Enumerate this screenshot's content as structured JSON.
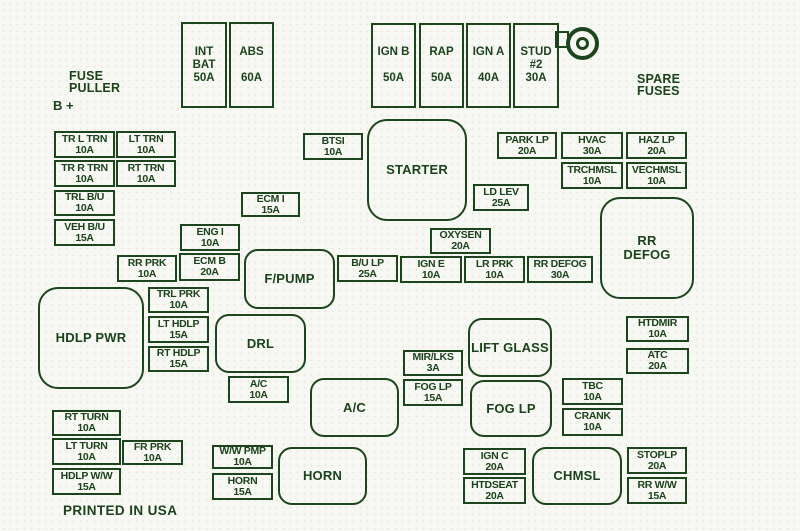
{
  "colors": {
    "line": "#1d451d",
    "background": "#f7f8f3"
  },
  "texts": {
    "fuse_puller": [
      "FUSE",
      "PULLER"
    ],
    "b_plus": "B +",
    "spare_fuses": [
      "SPARE",
      "FUSES"
    ],
    "printed_in_usa": "PRINTED IN USA"
  },
  "icons": {
    "stud_ring": "ring-terminal-icon"
  },
  "maxi_fuses": {
    "int_bat": {
      "name": "INT BAT",
      "amp": "50A"
    },
    "abs": {
      "name": "ABS",
      "amp": "60A"
    },
    "ign_b": {
      "name": "IGN B",
      "amp": "50A"
    },
    "rap": {
      "name": "RAP",
      "amp": "50A"
    },
    "ign_a": {
      "name": "IGN A",
      "amp": "40A"
    },
    "stud_2": {
      "name": "STUD #2",
      "amp": "30A"
    }
  },
  "fuses": {
    "tr_l_trn": {
      "name": "TR L TRN",
      "amp": "10A"
    },
    "lt_trn": {
      "name": "LT TRN",
      "amp": "10A"
    },
    "tr_r_trn": {
      "name": "TR R TRN",
      "amp": "10A"
    },
    "rt_trn": {
      "name": "RT TRN",
      "amp": "10A"
    },
    "trl_bu": {
      "name": "TRL B/U",
      "amp": "10A"
    },
    "veh_bu": {
      "name": "VEH B/U",
      "amp": "15A"
    },
    "btsi": {
      "name": "BTSI",
      "amp": "10A"
    },
    "park_lp": {
      "name": "PARK LP",
      "amp": "20A"
    },
    "hvac": {
      "name": "HVAC",
      "amp": "30A"
    },
    "haz_lp": {
      "name": "HAZ LP",
      "amp": "20A"
    },
    "trchmsl": {
      "name": "TRCHMSL",
      "amp": "10A"
    },
    "vechmsl": {
      "name": "VECHMSL",
      "amp": "10A"
    },
    "ecm_i": {
      "name": "ECM I",
      "amp": "15A"
    },
    "ld_lev": {
      "name": "LD LEV",
      "amp": "25A"
    },
    "eng_i": {
      "name": "ENG I",
      "amp": "10A"
    },
    "oxysen": {
      "name": "OXYSEN",
      "amp": "20A"
    },
    "rr_prk": {
      "name": "RR PRK",
      "amp": "10A"
    },
    "ecm_b": {
      "name": "ECM B",
      "amp": "20A"
    },
    "bu_lp": {
      "name": "B/U LP",
      "amp": "25A"
    },
    "ign_e": {
      "name": "IGN E",
      "amp": "10A"
    },
    "lr_prk": {
      "name": "LR PRK",
      "amp": "10A"
    },
    "rr_defog_fuse": {
      "name": "RR DEFOG",
      "amp": "30A"
    },
    "trl_prk": {
      "name": "TRL PRK",
      "amp": "10A"
    },
    "lt_hdlp": {
      "name": "LT HDLP",
      "amp": "15A"
    },
    "rt_hdlp": {
      "name": "RT HDLP",
      "amp": "15A"
    },
    "ac_fuse": {
      "name": "A/C",
      "amp": "10A"
    },
    "mir_lks": {
      "name": "MIR/LKS",
      "amp": "3A"
    },
    "fog_lp_fuse": {
      "name": "FOG LP",
      "amp": "15A"
    },
    "htdmir": {
      "name": "HTDMIR",
      "amp": "10A"
    },
    "atc": {
      "name": "ATC",
      "amp": "20A"
    },
    "tbc": {
      "name": "TBC",
      "amp": "10A"
    },
    "crank": {
      "name": "CRANK",
      "amp": "10A"
    },
    "rt_turn": {
      "name": "RT TURN",
      "amp": "10A"
    },
    "lt_turn": {
      "name": "LT TURN",
      "amp": "10A"
    },
    "fr_prk": {
      "name": "FR PRK",
      "amp": "10A"
    },
    "hdlp_ww": {
      "name": "HDLP W/W",
      "amp": "15A"
    },
    "ww_pmp": {
      "name": "W/W PMP",
      "amp": "10A"
    },
    "horn_fuse": {
      "name": "HORN",
      "amp": "15A"
    },
    "ign_c": {
      "name": "IGN C",
      "amp": "20A"
    },
    "htdseat": {
      "name": "HTDSEAT",
      "amp": "20A"
    },
    "stoplp": {
      "name": "STOPLP",
      "amp": "20A"
    },
    "rr_ww": {
      "name": "RR W/W",
      "amp": "15A"
    }
  },
  "relays": {
    "starter": "STARTER",
    "rr_defog": "RR DEFOG",
    "f_pump": "F/PUMP",
    "hdlp_pwr": "HDLP PWR",
    "drl": "DRL",
    "ac": "A/C",
    "lift_glass": "LIFT GLASS",
    "fog_lp": "FOG LP",
    "horn": "HORN",
    "chmsl": "CHMSL"
  }
}
